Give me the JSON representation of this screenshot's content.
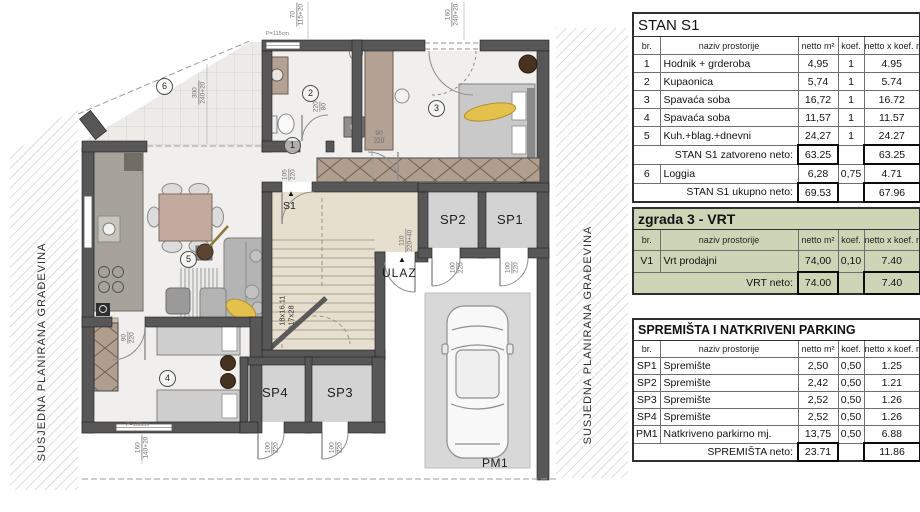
{
  "plan": {
    "boundary_left": "SUSJEDNA PLANIRANA GRAĐEVINA",
    "boundary_right": "SUSJEDNA PLANIRANA GRAĐEVINA",
    "room_numbers": [
      "1",
      "2",
      "3",
      "4",
      "5",
      "6"
    ],
    "labels": {
      "sp1": "SP1",
      "sp2": "SP2",
      "sp3": "SP3",
      "sp4": "SP4",
      "pm1": "PM1",
      "ulaz": "ULAZ",
      "stair": "S1"
    },
    "markers": {
      "stair_arrow": "▲",
      "entry_arrow": "▲"
    },
    "stair_note": {
      "line1": "18x16.11",
      "line2": "17x28"
    },
    "parapet": {
      "top": "P=115cm",
      "bottom": "P=100cm"
    },
    "dims": [
      {
        "top": "70",
        "bot": "115+20"
      },
      {
        "top": "160",
        "bot": "240+20"
      },
      {
        "top": "300",
        "bot": "240+20"
      },
      {
        "top": "90",
        "bot": "220"
      },
      {
        "top": "105",
        "bot": "220"
      },
      {
        "top": "220",
        "bot": "80"
      },
      {
        "top": "110",
        "bot": "220+40"
      },
      {
        "top": "100",
        "bot": "220"
      },
      {
        "top": "100",
        "bot": "220"
      },
      {
        "top": "100",
        "bot": "220"
      },
      {
        "top": "100",
        "bot": "220"
      },
      {
        "top": "90",
        "bot": "220"
      },
      {
        "top": "160",
        "bot": "140+20"
      }
    ]
  },
  "tables": {
    "stan": {
      "title": "STAN S1",
      "headers": [
        "br.",
        "naziv prostorije",
        "netto m²",
        "koef.",
        "netto x koef. m²"
      ],
      "rows": [
        [
          "1",
          "Hodnik + grderoba",
          "4,95",
          "1",
          "4.95"
        ],
        [
          "2",
          "Kupaonica",
          "5,74",
          "1",
          "5.74"
        ],
        [
          "3",
          "Spavaća soba",
          "16,72",
          "1",
          "16.72"
        ],
        [
          "4",
          "Spavaća soba",
          "11,57",
          "1",
          "11.57"
        ],
        [
          "5",
          "Kuh.+blag.+dnevni",
          "24,27",
          "1",
          "24.27"
        ]
      ],
      "subtotal": {
        "label": "STAN S1 zatvoreno neto:",
        "netto": "63.25",
        "prod": "63.25"
      },
      "loggia_row": [
        "6",
        "Loggia",
        "6,28",
        "0,75",
        "4.71"
      ],
      "total": {
        "label": "STAN S1 ukupno neto:",
        "netto": "69.53",
        "prod": "67.96"
      }
    },
    "vrt": {
      "title": "zgrada 3 - VRT",
      "headers": [
        "br.",
        "naziv prostorije",
        "netto m²",
        "koef.",
        "netto x koef. m²"
      ],
      "rows": [
        [
          "V1",
          "Vrt prodajni",
          "74,00",
          "0,10",
          "7.40"
        ]
      ],
      "total": {
        "label": "VRT neto:",
        "netto": "74.00",
        "prod": "7.40"
      }
    },
    "spremista": {
      "title": "SPREMIŠTA I NATKRIVENI PARKING",
      "headers": [
        "br.",
        "naziv prostorije",
        "netto m²",
        "koef.",
        "netto x koef. m²"
      ],
      "rows": [
        [
          "SP1",
          "Spremište",
          "2,50",
          "0,50",
          "1.25"
        ],
        [
          "SP2",
          "Spremište",
          "2,42",
          "0,50",
          "1.21"
        ],
        [
          "SP3",
          "Spremište",
          "2,52",
          "0,50",
          "1.26"
        ],
        [
          "SP4",
          "Spremište",
          "2,52",
          "0,50",
          "1.26"
        ],
        [
          "PM1",
          "Natkriveno parkirno mj.",
          "13,75",
          "0,50",
          "6.88"
        ]
      ],
      "total": {
        "label": "SPREMIŠTA neto:",
        "netto": "23.71",
        "prod": "11.86"
      }
    }
  },
  "colors": {
    "wall": "#575757",
    "stair_floor": "#e7dfcd",
    "apartment_floor": "#f0efed",
    "vrt_table_bg": "#ccd6b6",
    "closet": "#b09e8f",
    "person": "#e4c04d"
  }
}
